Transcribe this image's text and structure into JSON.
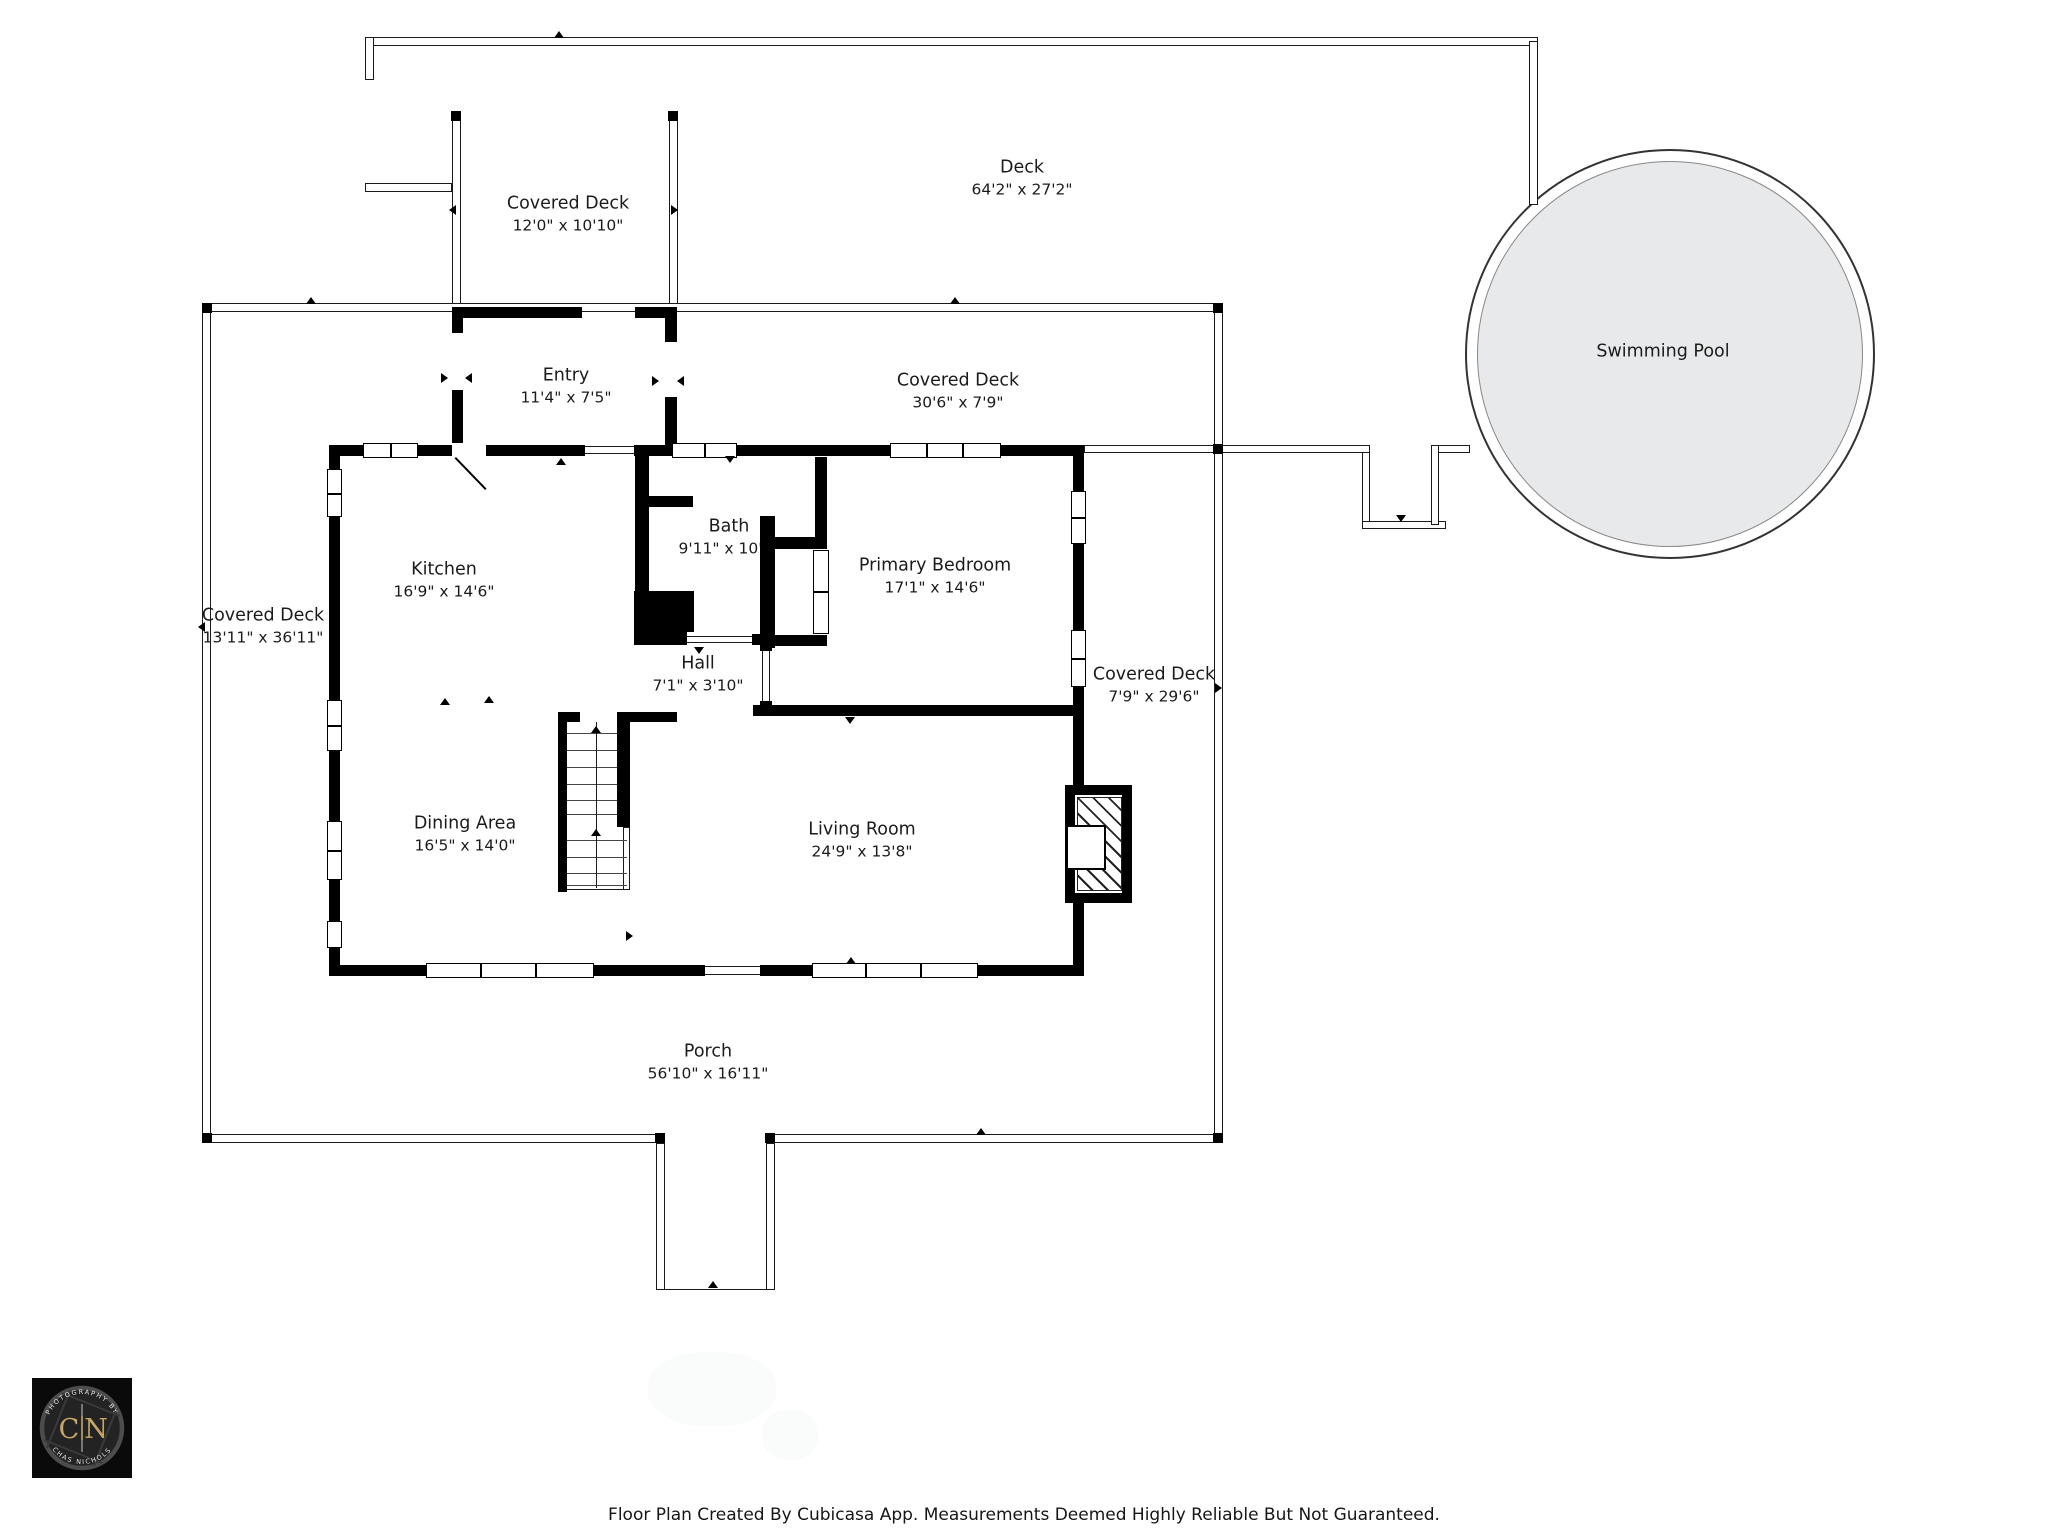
{
  "rooms": {
    "deck": {
      "name": "Deck",
      "dims": "64'2\" x 27'2\""
    },
    "covered_deck_top": {
      "name": "Covered Deck",
      "dims": "12'0\" x 10'10\""
    },
    "entry": {
      "name": "Entry",
      "dims": "11'4\" x 7'5\""
    },
    "covered_deck_upper": {
      "name": "Covered Deck",
      "dims": "30'6\" x 7'9\""
    },
    "swimming_pool": {
      "name": "Swimming Pool"
    },
    "kitchen": {
      "name": "Kitchen",
      "dims": "16'9\" x 14'6\""
    },
    "bath": {
      "name": "Bath",
      "dims": "9'11\" x 10'4\""
    },
    "primary_bedroom": {
      "name": "Primary Bedroom",
      "dims": "17'1\" x 14'6\""
    },
    "covered_deck_left": {
      "name": "Covered Deck",
      "dims": "13'11\" x 36'11\""
    },
    "hall": {
      "name": "Hall",
      "dims": "7'1\" x 3'10\""
    },
    "covered_deck_right": {
      "name": "Covered Deck",
      "dims": "7'9\" x 29'6\""
    },
    "dining_area": {
      "name": "Dining Area",
      "dims": "16'5\" x 14'0\""
    },
    "living_room": {
      "name": "Living Room",
      "dims": "24'9\" x 13'8\""
    },
    "porch": {
      "name": "Porch",
      "dims": "56'10\" x 16'11\""
    }
  },
  "footer": {
    "disclaimer": "Floor Plan Created By Cubicasa App. Measurements Deemed Highly Reliable But Not Guaranteed."
  },
  "logo": {
    "initials_left": "C",
    "initials_right": "N",
    "arc_top": "PHOTOGRAPHY BY",
    "arc_bottom": "CHAS NICHOLS",
    "gold": "#c6a566",
    "background": "#0a0a0a",
    "ring": "#4c4c4c"
  },
  "colors": {
    "wall": "#000000",
    "pool_fill": "#e8e9ea",
    "label_text": "#1b1b1b"
  }
}
